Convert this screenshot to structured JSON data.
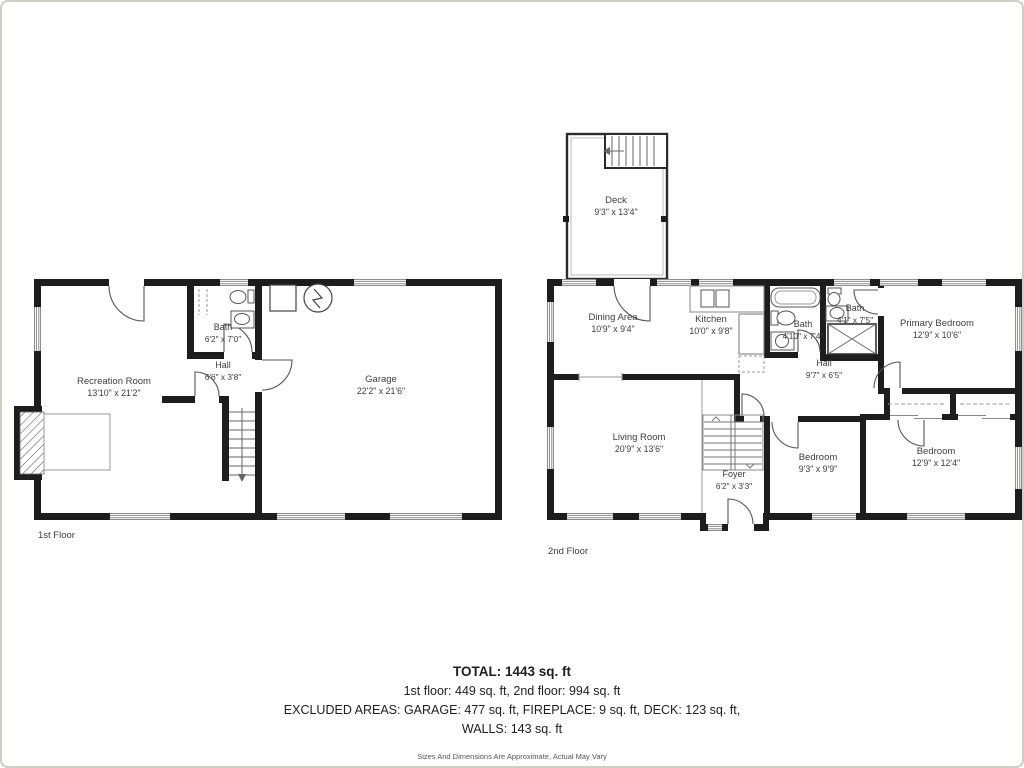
{
  "floors": [
    {
      "label": "1st Floor",
      "rooms": [
        {
          "name": "Recreation Room",
          "dims": "13'10\" x 21'2\""
        },
        {
          "name": "Bath",
          "dims": "6'2\" x 7'0\""
        },
        {
          "name": "Hall",
          "dims": "6'6\" x 3'8\""
        },
        {
          "name": "Garage",
          "dims": "22'2\" x 21'6\""
        }
      ]
    },
    {
      "label": "2nd Floor",
      "rooms": [
        {
          "name": "Deck",
          "dims": "9'3\" x 13'4\""
        },
        {
          "name": "Dining Area",
          "dims": "10'9\" x 9'4\""
        },
        {
          "name": "Kitchen",
          "dims": "10'0\" x 9'8\""
        },
        {
          "name": "Bath",
          "dims": "4'10\" x 7'4\""
        },
        {
          "name": "Bath",
          "dims": "4'1\" x 7'5\""
        },
        {
          "name": "Primary Bedroom",
          "dims": "12'9\" x 10'6\""
        },
        {
          "name": "Hall",
          "dims": "9'7\" x 6'5\""
        },
        {
          "name": "Living Room",
          "dims": "20'9\" x 13'6\""
        },
        {
          "name": "Foyer",
          "dims": "6'2\" x 3'3\""
        },
        {
          "name": "Bedroom",
          "dims": "9'3\" x 9'9\""
        },
        {
          "name": "Bedroom",
          "dims": "12'9\" x 12'4\""
        }
      ]
    }
  ],
  "summary": {
    "total": "TOTAL: 1443 sq. ft",
    "floors_line": "1st floor: 449 sq. ft, 2nd floor: 994 sq. ft",
    "excluded_line": "EXCLUDED AREAS: GARAGE: 477 sq. ft, FIREPLACE: 9 sq. ft, DECK: 123 sq. ft,",
    "walls_line": "WALLS: 143 sq. ft",
    "disclaimer": "Sizes And Dimensions Are Approximate, Actual May Vary"
  },
  "colors": {
    "wall": "#1d1d1d",
    "line": "#555555",
    "window": "#8a8a8a"
  }
}
